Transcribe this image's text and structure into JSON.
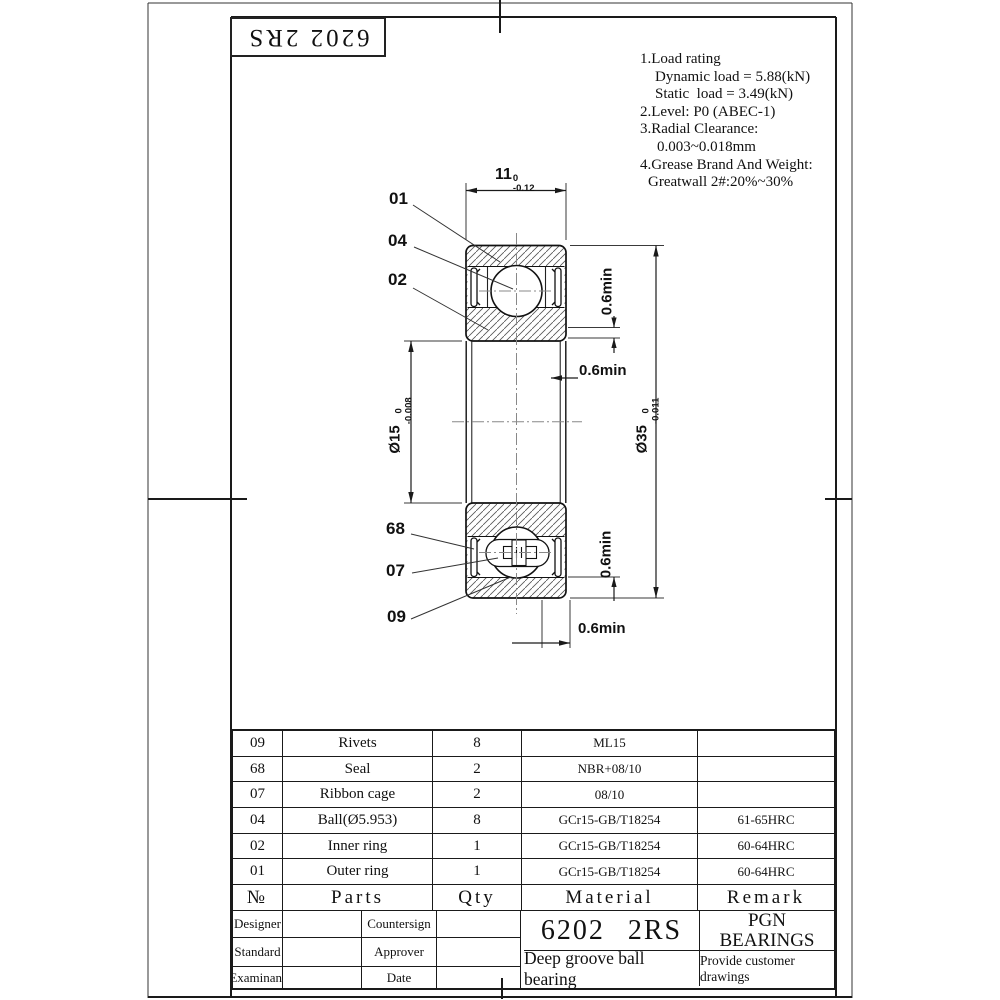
{
  "sheet": {
    "stamp": "6202 2RS"
  },
  "notes": {
    "lines": [
      "1.Load rating",
      "Dynamic load = 5.88(kN)",
      "Static  load = 3.49(kN)",
      "2.Level: P0 (ABEC-1)",
      "3.Radial Clearance:",
      "0.003~0.018mm",
      "4.Grease Brand And Weight:",
      "Greatwall 2#:20%~30%"
    ]
  },
  "drawing": {
    "part_labels": {
      "l01": "01",
      "l04": "04",
      "l02": "02",
      "l68": "68",
      "l07": "07",
      "l09": "09"
    },
    "dims": {
      "width": {
        "value": "11",
        "tol_upper": "0",
        "tol_lower": "-0.12"
      },
      "bore": {
        "value": "Ø15",
        "tol_upper": "0",
        "tol_lower": "-0.008"
      },
      "od": {
        "value": "Ø35",
        "tol_upper": "0",
        "tol_lower": "-0.011"
      },
      "recess_top": "0.6min",
      "chamfer_mid": "0.6min",
      "recess_bottom": "0.6min",
      "chamfer_bottom": "0.6min"
    }
  },
  "parts_table": {
    "headers": {
      "no": "№",
      "parts": "Parts",
      "qty": "Qty",
      "material": "Material",
      "remark": "Remark"
    },
    "rows": [
      {
        "no": "09",
        "parts": "Rivets",
        "qty": "8",
        "material": "ML15",
        "remark": ""
      },
      {
        "no": "68",
        "parts": "Seal",
        "qty": "2",
        "material": "NBR+08/10",
        "remark": ""
      },
      {
        "no": "07",
        "parts": "Ribbon cage",
        "qty": "2",
        "material": "08/10",
        "remark": ""
      },
      {
        "no": "04",
        "parts": "Ball(Ø5.953)",
        "qty": "8",
        "material": "GCr15-GB/T18254",
        "remark": "61-65HRC"
      },
      {
        "no": "02",
        "parts": "Inner ring",
        "qty": "1",
        "material": "GCr15-GB/T18254",
        "remark": "60-64HRC"
      },
      {
        "no": "01",
        "parts": "Outer ring",
        "qty": "1",
        "material": "GCr15-GB/T18254",
        "remark": "60-64HRC"
      }
    ]
  },
  "title_block": {
    "designer": "Designer",
    "standard": "Standard",
    "examinant": "Examinant",
    "countersign": "Countersign",
    "approver": "Approver",
    "date": "Date",
    "part_number": "6202 2RS",
    "product_name": "Deep groove ball bearing",
    "company_line1": "PGN",
    "company_line2": "BEARINGS",
    "remark": "Provide customer drawings"
  },
  "colors": {
    "line": "#1a1a1a",
    "hatch": "#555555",
    "centerline": "#888888",
    "dim": "#3a3a3a"
  }
}
